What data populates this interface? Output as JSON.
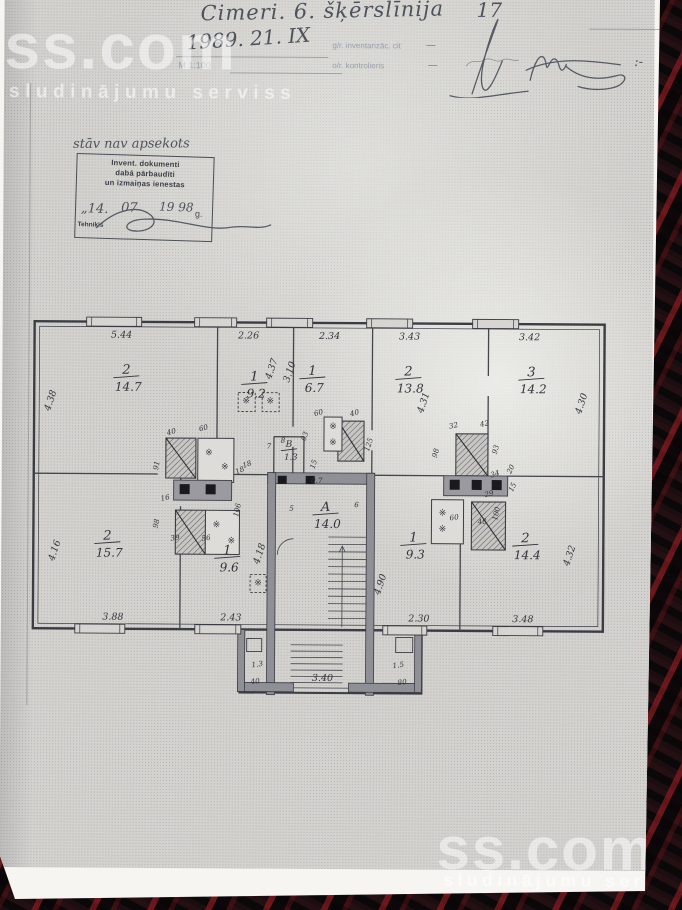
{
  "watermarks": {
    "brand": "ss.com",
    "tagline": "sludinājumu serviss"
  },
  "header": {
    "address": "Cimeri. 6. šķērslīnija",
    "house_number": "17",
    "date": "1989. 21. IX",
    "inventory_label": "g/r. inventarizāc. cit",
    "inventory_dash": "—",
    "scale": "M 1:100",
    "controller_label": "o/r. kontrolieris",
    "controller_dash": "—",
    "controller_dash2": ":-"
  },
  "stamp": {
    "note_above": "stāv nav apsekots",
    "line1": "Invent. dokumenti",
    "line2": "dabā pārbaudīti",
    "line3": "un izmaiņas ienestas",
    "date_day": "„14.",
    "date_month": "07",
    "date_year": "19 98",
    "date_suffix": "g.",
    "role": "Tehniķis"
  },
  "icons": {
    "vent_glyph": "※"
  },
  "plan": {
    "rooms": [
      {
        "n": "2",
        "a": "14.7",
        "x": 100,
        "y": 60
      },
      {
        "n": "1",
        "a": "9.2",
        "x": 228,
        "y": 66
      },
      {
        "n": "1",
        "a": "6.7",
        "x": 286,
        "y": 60
      },
      {
        "n": "2",
        "a": "13.8",
        "x": 382,
        "y": 60
      },
      {
        "n": "3",
        "a": "14.2",
        "x": 505,
        "y": 60
      },
      {
        "n": "2",
        "a": "15.7",
        "x": 82,
        "y": 226
      },
      {
        "n": "1",
        "a": "9.6",
        "x": 202,
        "y": 240
      },
      {
        "n": "A",
        "a": "14.0",
        "x": 300,
        "y": 196
      },
      {
        "n": "1",
        "a": "9.3",
        "x": 388,
        "y": 226
      },
      {
        "n": "2",
        "a": "14.4",
        "x": 500,
        "y": 226
      },
      {
        "n": "B",
        "a": "1.3",
        "x": 263,
        "y": 132,
        "s": true
      }
    ],
    "dims_top": {
      "y": 24,
      "items": [
        [
          "5.44",
          95
        ],
        [
          "2.26",
          222
        ],
        [
          "2.34",
          303
        ],
        [
          "3.43",
          383
        ],
        [
          "3.42",
          503
        ]
      ]
    },
    "dims_bottom": {
      "y": 306,
      "items": [
        [
          "3.88",
          88
        ],
        [
          "2.43",
          206
        ],
        [
          "2.30",
          394
        ],
        [
          "3.48",
          498
        ]
      ]
    },
    "entry_dim": [
      "3.40",
      298,
      366
    ],
    "dims_side": [
      [
        "4.38",
        27,
        88
      ],
      [
        "4.16",
        32,
        238
      ],
      [
        "4.37",
        248,
        55
      ],
      [
        "3.10",
        266,
        58
      ],
      [
        "4.31",
        400,
        88
      ],
      [
        "4.30",
        558,
        88
      ],
      [
        "4.18",
        237,
        240
      ],
      [
        "4.90",
        358,
        270
      ],
      [
        "4.32",
        547,
        240
      ]
    ],
    "small_labels": [
      [
        "40",
        146,
        120,
        -15
      ],
      [
        "60",
        178,
        116,
        -15
      ],
      [
        "91",
        133,
        152,
        -78
      ],
      [
        "18",
        215,
        158,
        -25
      ],
      [
        "16",
        140,
        186,
        -12
      ],
      [
        "106",
        214,
        196,
        -78
      ],
      [
        "98",
        133,
        210,
        -78
      ],
      [
        "39",
        150,
        226,
        -8
      ],
      [
        "56",
        181,
        226,
        -8
      ],
      [
        "60",
        293,
        100,
        -15
      ],
      [
        "40",
        329,
        100,
        -15
      ],
      [
        "03",
        281,
        122,
        -72
      ],
      [
        "125",
        345,
        130,
        -72
      ],
      [
        "15",
        290,
        150,
        -72
      ],
      [
        "0.7",
        291,
        168,
        0
      ],
      [
        "18",
        222,
        152,
        -20
      ],
      [
        "7",
        243,
        134,
        0
      ],
      [
        "8",
        257,
        128,
        0
      ],
      [
        "5",
        266,
        196,
        0
      ],
      [
        "6",
        331,
        192,
        0
      ],
      [
        "32",
        428,
        112,
        -12
      ],
      [
        "42",
        459,
        110,
        -12
      ],
      [
        "98",
        412,
        138,
        -75
      ],
      [
        "93",
        472,
        134,
        -75
      ],
      [
        "34",
        470,
        160,
        -20
      ],
      [
        "20",
        487,
        154,
        -65
      ],
      [
        "29",
        464,
        180,
        -15
      ],
      [
        "15",
        489,
        172,
        -65
      ],
      [
        "100",
        473,
        198,
        -78
      ],
      [
        "60",
        429,
        204,
        -8
      ],
      [
        "48",
        457,
        208,
        -8
      ],
      [
        "1.3",
        233,
        352,
        -8
      ],
      [
        "40",
        231,
        369,
        -8
      ],
      [
        "1.5",
        374,
        352,
        -8
      ],
      [
        "80",
        378,
        369,
        -8
      ]
    ],
    "vent_glyphs": [
      [
        183,
        141
      ],
      [
        199,
        155
      ],
      [
        191,
        213
      ],
      [
        206,
        229
      ],
      [
        307,
        114
      ],
      [
        307,
        130
      ],
      [
        417,
        200
      ],
      [
        417,
        216
      ],
      [
        220,
        89
      ],
      [
        244,
        89
      ],
      [
        233,
        271
      ]
    ]
  }
}
